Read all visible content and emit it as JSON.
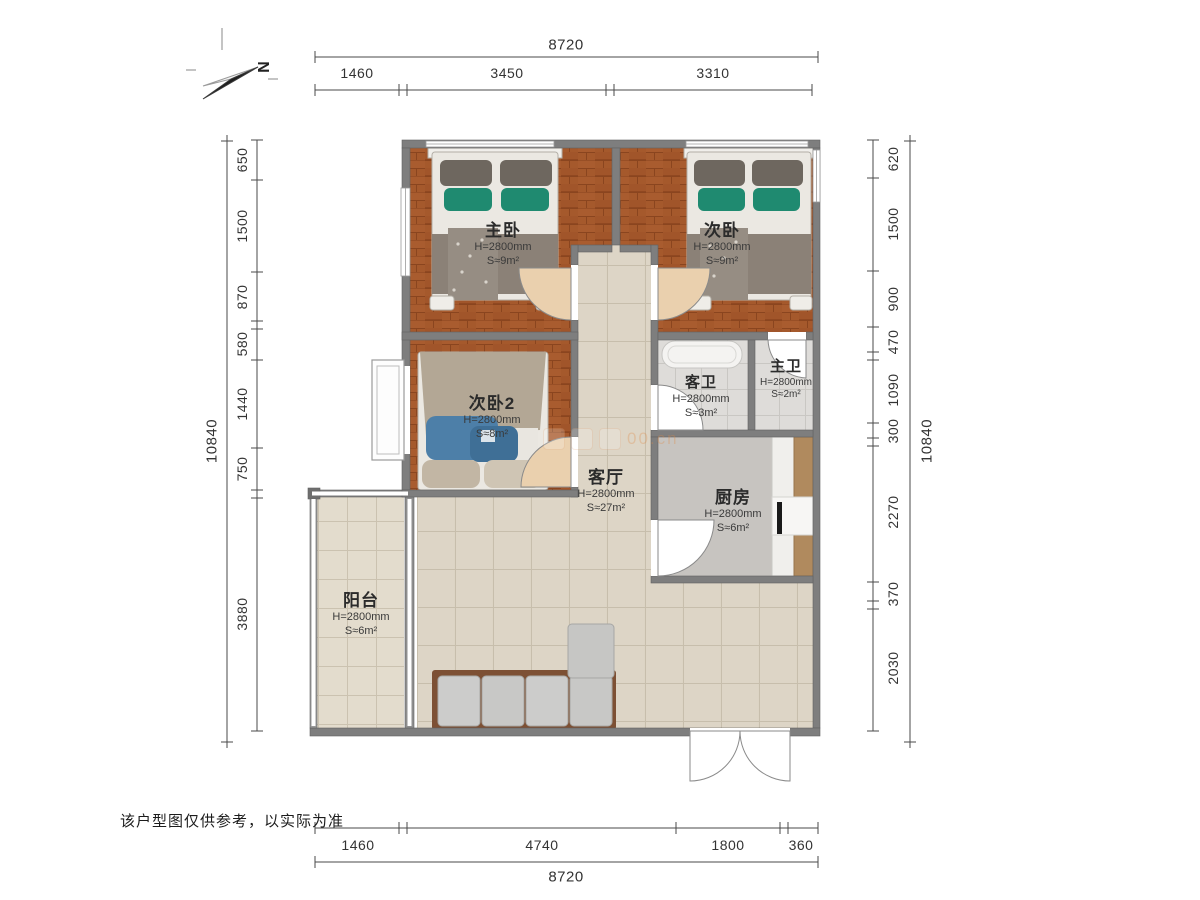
{
  "compass": {
    "label": "N"
  },
  "dimensions": {
    "top": {
      "total": "8720",
      "segments": [
        "1460",
        "3450",
        "3310"
      ]
    },
    "bottom": {
      "total": "8720",
      "segments": [
        "1460",
        "4740",
        "1800",
        "360"
      ]
    },
    "left": {
      "total": "10840",
      "segments": [
        "650",
        "1500",
        "870",
        "580",
        "1440",
        "750",
        "3880"
      ]
    },
    "right": {
      "total": "10840",
      "segments": [
        "620",
        "1500",
        "900",
        "470",
        "1090",
        "300",
        "2270",
        "370",
        "2030"
      ]
    }
  },
  "rooms": {
    "master_bedroom": {
      "name": "主卧",
      "ceiling": "H=2800mm",
      "area": "S≈9m²"
    },
    "bedroom2": {
      "name": "次卧",
      "ceiling": "H=2800mm",
      "area": "S≈9m²"
    },
    "bedroom3": {
      "name": "次卧2",
      "ceiling": "H=2800mm",
      "area": "S≈8m²"
    },
    "guest_bath": {
      "name": "客卫",
      "ceiling": "H=2800mm",
      "area": "S≈3m²"
    },
    "master_bath": {
      "name": "主卫",
      "ceiling": "H=2800mm",
      "area": "S≈2m²"
    },
    "living_room": {
      "name": "客厅",
      "ceiling": "H=2800mm",
      "area": "S≈27m²"
    },
    "kitchen": {
      "name": "厨房",
      "ceiling": "H=2800mm",
      "area": "S≈6m²"
    },
    "balcony": {
      "name": "阳台",
      "ceiling": "H=2800mm",
      "area": "S≈6m²"
    }
  },
  "watermark": {
    "partial_text": "00.cn"
  },
  "footer": {
    "disclaimer": "该户型图仅供参考，以实际为准"
  }
}
